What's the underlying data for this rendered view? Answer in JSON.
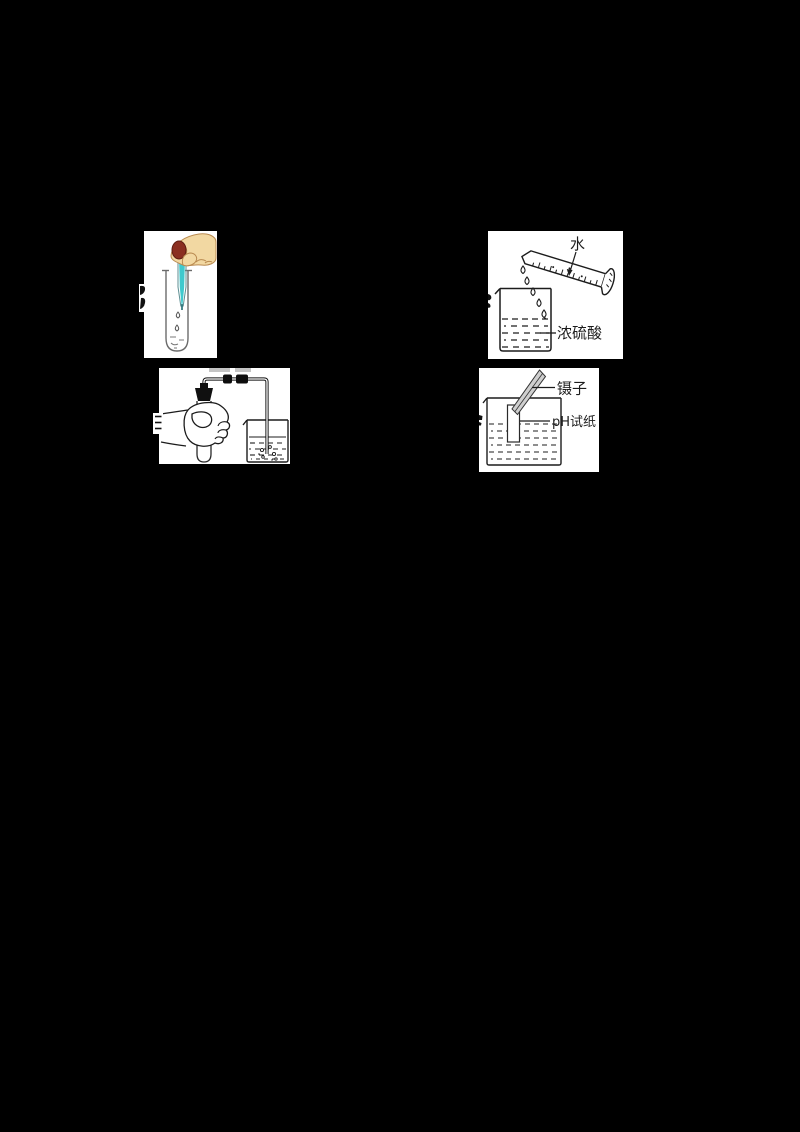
{
  "canvas": {
    "width": 800,
    "height": 1132,
    "background": "#000000"
  },
  "colors": {
    "background": "#000000",
    "panel": "#ffffff",
    "ink": "#1c1c1c",
    "tube_gray": "#6b6b6b",
    "skin": "#f2d8a2",
    "skin_outline": "#b98a50",
    "bulb": "#8b2f20",
    "reagent": "#3fc9cd"
  },
  "figures": {
    "dilution": {
      "water_label": "水",
      "acid_label": "浓硫酸"
    },
    "ph_test": {
      "tweezers_label": "镊子",
      "paper_label": "pH试纸"
    }
  }
}
